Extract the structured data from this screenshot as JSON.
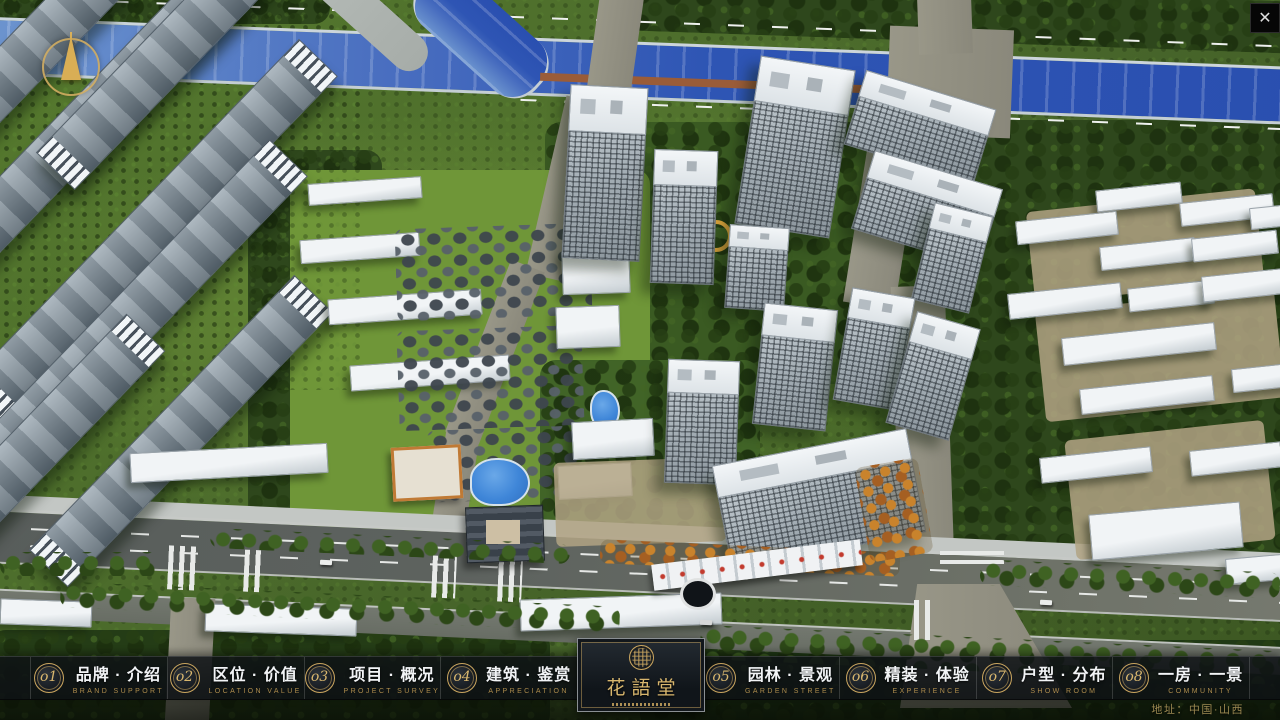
{
  "colors": {
    "gold": "#c9a55f",
    "goldBright": "#d9b76e",
    "enText": "#ad8c4d",
    "barBg": "rgba(14,18,22,0.84)"
  },
  "ui": {
    "close_button": "✕",
    "address": "地址：中国·山西",
    "logo": {
      "title": "花語堂",
      "seal_icon": "round-seal-emblem"
    },
    "compass_icon": "north-compass-arrow",
    "menu": [
      {
        "num": "o1",
        "zh": "品牌 · 介绍",
        "en": "BRAND SUPPORT"
      },
      {
        "num": "o2",
        "zh": "区位 · 价值",
        "en": "LOCATION VALUE"
      },
      {
        "num": "o3",
        "zh": "项目 · 概况",
        "en": "PROJECT SURVEY"
      },
      {
        "num": "o4",
        "zh": "建筑 · 鉴赏",
        "en": "APPRECIATION"
      },
      {
        "num": "o5",
        "zh": "园林 · 景观",
        "en": "GARDEN STREET"
      },
      {
        "num": "o6",
        "zh": "精装 · 体验",
        "en": "EXPERIENCE"
      },
      {
        "num": "o7",
        "zh": "户型 · 分布",
        "en": "SHOW ROOM"
      },
      {
        "num": "o8",
        "zh": "一房 · 一景",
        "en": "COMMUNITY"
      }
    ]
  }
}
